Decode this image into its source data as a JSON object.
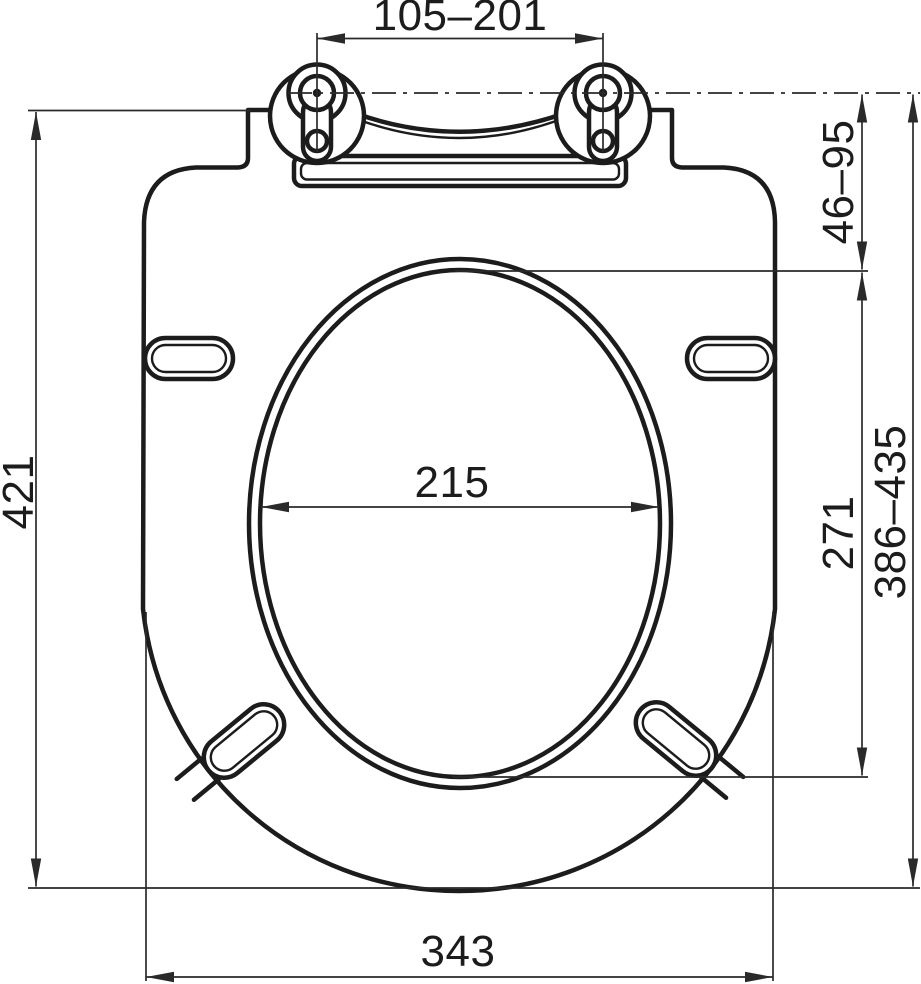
{
  "drawing": {
    "subject": "toilet-seat-top-view-dimensioned-drawing",
    "colors": {
      "background": "#ffffff",
      "outline": "#1c1c1c",
      "dimension_lines": "#2a2a2a"
    },
    "dimensions": {
      "hinge_spacing": "105–201",
      "hinge_axis_to_lid_top": "46–95",
      "overall_length": "421",
      "hinge_axis_to_front": "386–435",
      "opening_length": "271",
      "opening_width": "215",
      "overall_width": "343"
    }
  }
}
